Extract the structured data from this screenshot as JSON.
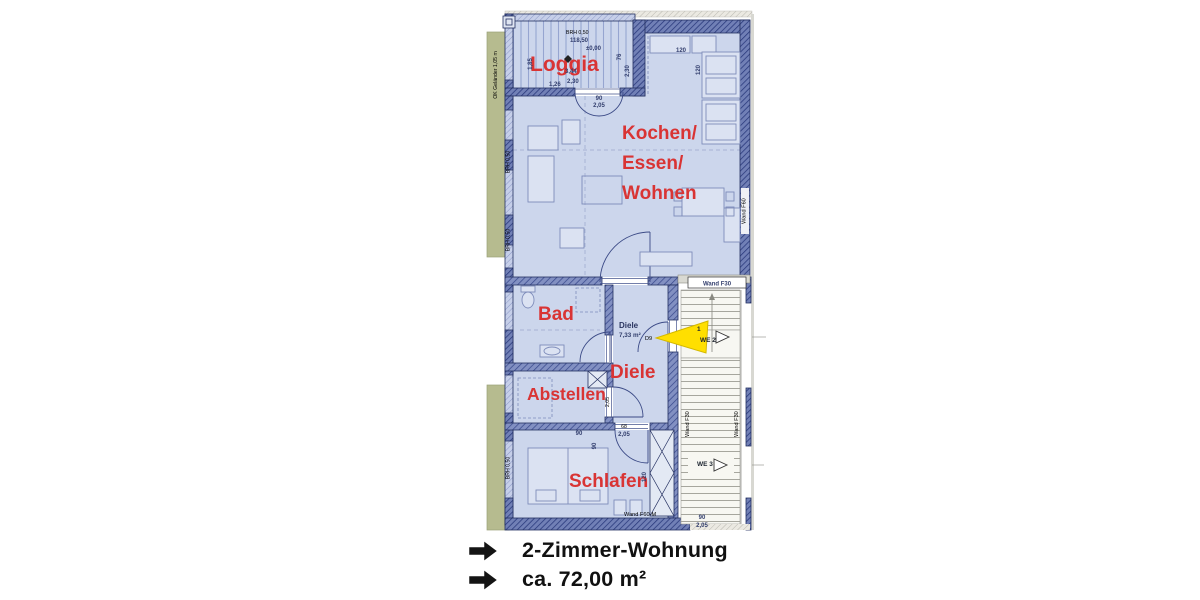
{
  "window": {
    "background": "#ffffff"
  },
  "summary": {
    "bullet_icon": "heavy-right-arrow",
    "line1": "2-Zimmer-Wohnung",
    "line2": "ca. 72,00 m²"
  },
  "plan": {
    "rooms": {
      "loggia": "Loggia",
      "kitchen_line1": "Kochen/",
      "kitchen_line2": "Essen/",
      "kitchen_line3": "Wohnen",
      "bad": "Bad",
      "diele": "Diele",
      "abstellen": "Abstellen",
      "schlafen": "Schlafen"
    },
    "hall": {
      "label": "Diele",
      "area": "7,33 m²",
      "door_id": "D9"
    },
    "stairwell": {
      "wand_f30_top": "Wand F30",
      "wand_f30_left": "Wand F30",
      "wand_f30_right": "Wand F30",
      "unit_number": "1",
      "we2": "WE 2",
      "we3": "WE 3",
      "door_width": "90",
      "door_height": "2,05"
    },
    "walls": {
      "wand_f60": "Wand F60",
      "wand_f60m": "Wand F60-M",
      "brh": "BRH 0,50",
      "gelaender": "OK Geländer 1,05 m"
    },
    "loggia_dims": {
      "width_left": "1,85",
      "len1": "3,44",
      "len2": "2,30",
      "d76": "76",
      "right": "2,30",
      "bottom": "1,26",
      "brh_top": "BRH 0,50",
      "level_height": "118,50",
      "level_zero": "±0,00"
    },
    "door_dims": {
      "french_w": "90",
      "french_h": "2,05",
      "hall_w": "68",
      "hall_h": "2,05",
      "side_w": "90",
      "abst_v": "2,05",
      "schlafen_side": "90"
    },
    "kitchen_dims": {
      "counter_top": "120",
      "counter_side": "120"
    },
    "shaft_dim": "120",
    "colors": {
      "room_fill": "#ccd6ec",
      "wall_blue": "#7180b6",
      "wall_line": "#27377a",
      "label_red": "#d93434",
      "arrow_yellow": "#ffdf00",
      "terrace_green": "#b6bb8f",
      "stair_white": "#f7f7f2"
    }
  }
}
